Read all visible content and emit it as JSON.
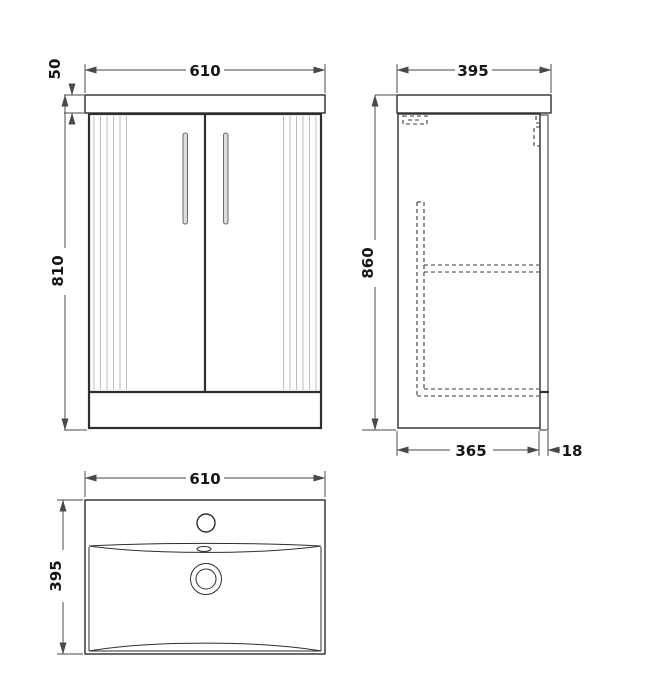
{
  "drawing": {
    "views": {
      "front": {
        "width_mm": "610",
        "worktop_height_mm": "50",
        "cabinet_height_mm": "810"
      },
      "side": {
        "depth_mm": "395",
        "height_mm": "860",
        "carcass_depth_mm": "365",
        "door_thickness_mm": "18"
      },
      "basin": {
        "width_mm": "610",
        "depth_mm": "395"
      }
    },
    "theme": {
      "background": "#ffffff",
      "object_line": "#2e2e2e",
      "dimension_line": "#4a4a4a",
      "text_color": "#161616",
      "flute_line": "#bdbdbd",
      "handle_fill": "#dddddd",
      "handle_stroke": "#6b6b6b"
    }
  }
}
